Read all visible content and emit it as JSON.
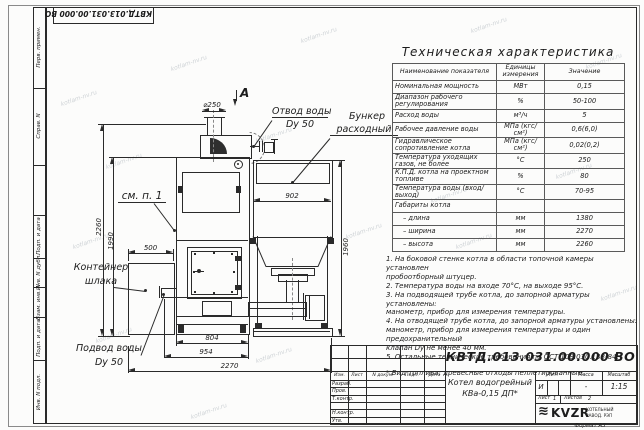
{
  "watermark": {
    "text": "kotlam-nv.ru"
  },
  "frame": {
    "top_stamp_number": "КВТД.013.031.00.000 ВО",
    "format_note": "Формат А3",
    "margin_labels": [
      "Перв. примен.",
      "Справ. N",
      "Подп. и дата",
      "Инв. N дубл.",
      "Взам. инв. N",
      "Подп. и дата",
      "Инв. N подл."
    ]
  },
  "spec_table": {
    "title": "Техническая характеристика",
    "headers": [
      "Наименование показателя",
      "Единицы измерения",
      "Значение"
    ],
    "rows": [
      [
        "Номинальная мощность",
        "МВт",
        "0,15"
      ],
      [
        "Диапазон рабочего регулирования",
        "%",
        "50-100"
      ],
      [
        "Расход воды",
        "м³/ч",
        "5"
      ],
      [
        "Рабочее давление воды",
        "МПа (кгс/см²)",
        "0,6(6,0)"
      ],
      [
        "Гидравлическое сопротивление котла",
        "МПа (кгс/см²)",
        "0,02(0,2)"
      ],
      [
        "Температура уходящих газов, не более",
        "°С",
        "250"
      ],
      [
        "К.П.Д. котла на проектном топливе",
        "%",
        "80"
      ],
      [
        "Температура воды (вход/выход)",
        "°С",
        "70-95"
      ],
      [
        "Габариты котла",
        "",
        ""
      ],
      [
        "– длина",
        "мм",
        "1380"
      ],
      [
        "– ширина",
        "мм",
        "2270"
      ],
      [
        "– высота",
        "мм",
        "2260"
      ]
    ]
  },
  "notes": {
    "lines": [
      "1. На боковой стенке котла в области топочной камеры установлен",
      "пробоотборный штуцер.",
      "2. Температура воды на входе 70°С, на выходе 95°С.",
      "3. На подводящей трубе котла, до запорной арматуры установлены:",
      "манометр, прибор для измерения температуры.",
      "4. На отводящей трубе котла, до запорной арматуры установлены:",
      "манометр, прибор для измерения температуры и один предохранительный",
      "клапан Dу не менее 40 мм.",
      "5. Остальные технические требования по ОСТ 108.030.133-84.",
      "",
      "* Вид топлива: древесные отходы пеллетированные."
    ]
  },
  "drawing": {
    "view_marker": "А",
    "labels": {
      "otvod_line1": "Отвод воды",
      "otvod_line2": "Dy 50",
      "bunker_line1": "Бункер",
      "bunker_line2": "расходный",
      "see_note": "см. п. 1",
      "slag_line1": "Контейнер",
      "slag_line2": "шлака",
      "podvod_line1": "Подвод воды",
      "podvod_line2": "Dy 50"
    },
    "dims": {
      "dia250": "⌀250",
      "w902": "902",
      "h1960": "1960",
      "h2260": "2260",
      "h1990": "1990",
      "w500": "500",
      "w804": "804",
      "w954": "954",
      "w2270": "2270"
    }
  },
  "title_block": {
    "doc_number": "КВТД.013.031.00.000 ВО",
    "columns": {
      "izm": "Изм.",
      "list": "Лист",
      "docum": "N докум.",
      "podp": "Подп.",
      "data": "Дата"
    },
    "role_rows": [
      "Разраб.",
      "Пров.",
      "Т.контр.",
      "",
      "Н.контр.",
      "Утв."
    ],
    "product_name_line1": "Котел водогрейный",
    "product_name_line2": "КВа-0,15 ДП*",
    "lit_header": "Лит.",
    "mass_header": "Масса",
    "scale_header": "Масштаб",
    "lit_value": "И",
    "mass_value": "-",
    "scale_value": "1:15",
    "sheet_label": "Лист",
    "sheet_value": "1",
    "sheets_label": "Листов",
    "sheets_value": "2",
    "logo_glyph": "≋",
    "logo_text": "KVZR",
    "company_line1": "КОТЕЛЬНЫЙ",
    "company_line2": "ЗАВОД. РЭП"
  }
}
